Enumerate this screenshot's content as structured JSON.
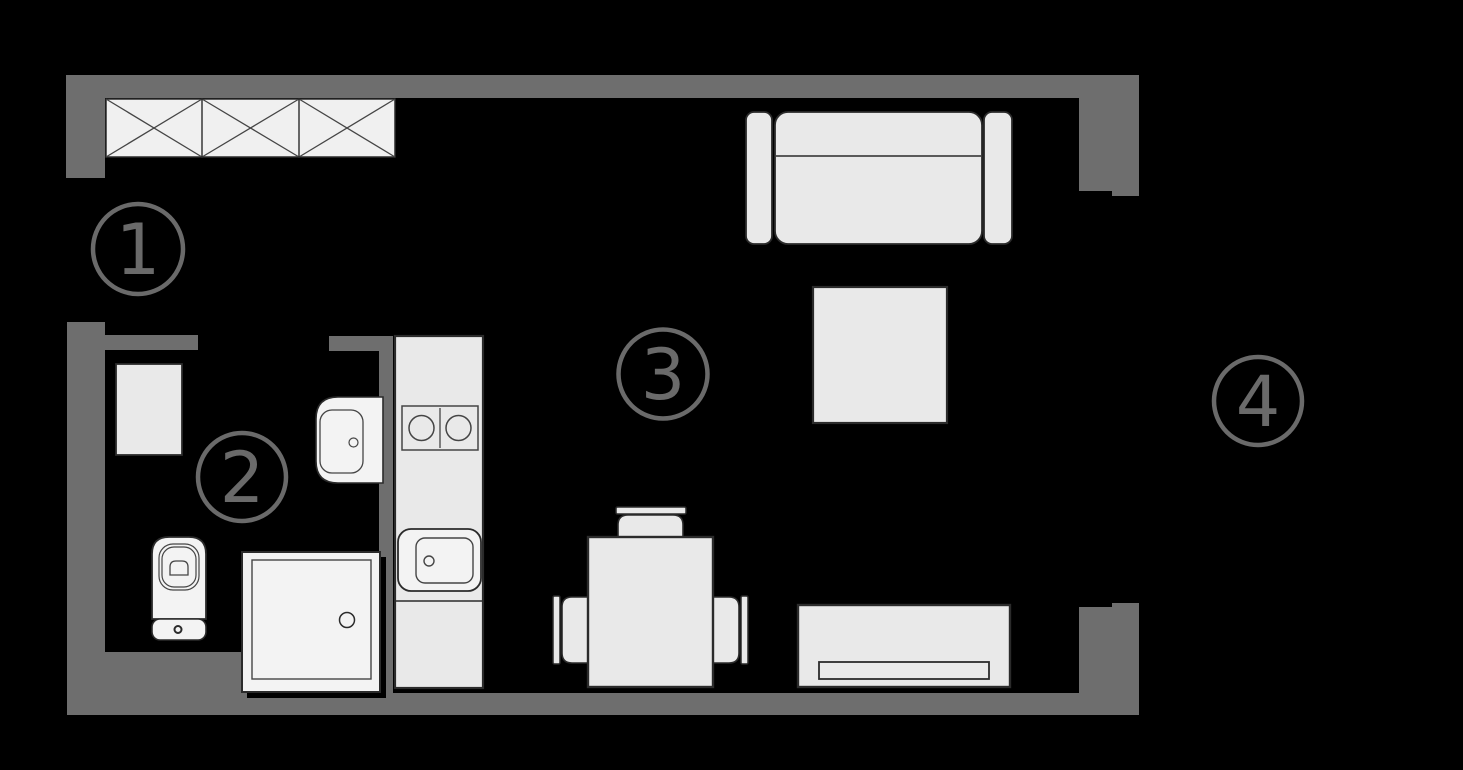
{
  "plan": {
    "type": "apartment-floor-plan",
    "rooms": [
      {
        "label": "1",
        "furniture": [
          "wardrobe"
        ]
      },
      {
        "label": "2",
        "furniture": [
          "washing-machine",
          "bathroom-sink",
          "toilet",
          "shower"
        ]
      },
      {
        "label": "3",
        "furniture": [
          "sofa",
          "coffee-table",
          "sideboard",
          "dining-table",
          "chair",
          "chair",
          "chair",
          "kitchen-counter",
          "cooktop",
          "kitchen-sink"
        ]
      },
      {
        "label": "4",
        "furniture": []
      }
    ]
  },
  "colors": {
    "canvas_bg": "#000000",
    "wall": "#6e6e6e",
    "furniture_fill": "#e9e9e9",
    "fixture_fill": "#f3f3f3",
    "wardrobe_fill": "#f0f0f0",
    "outline": "#2b2b2b",
    "detail": "#454545",
    "label": "#6a6a6a"
  }
}
